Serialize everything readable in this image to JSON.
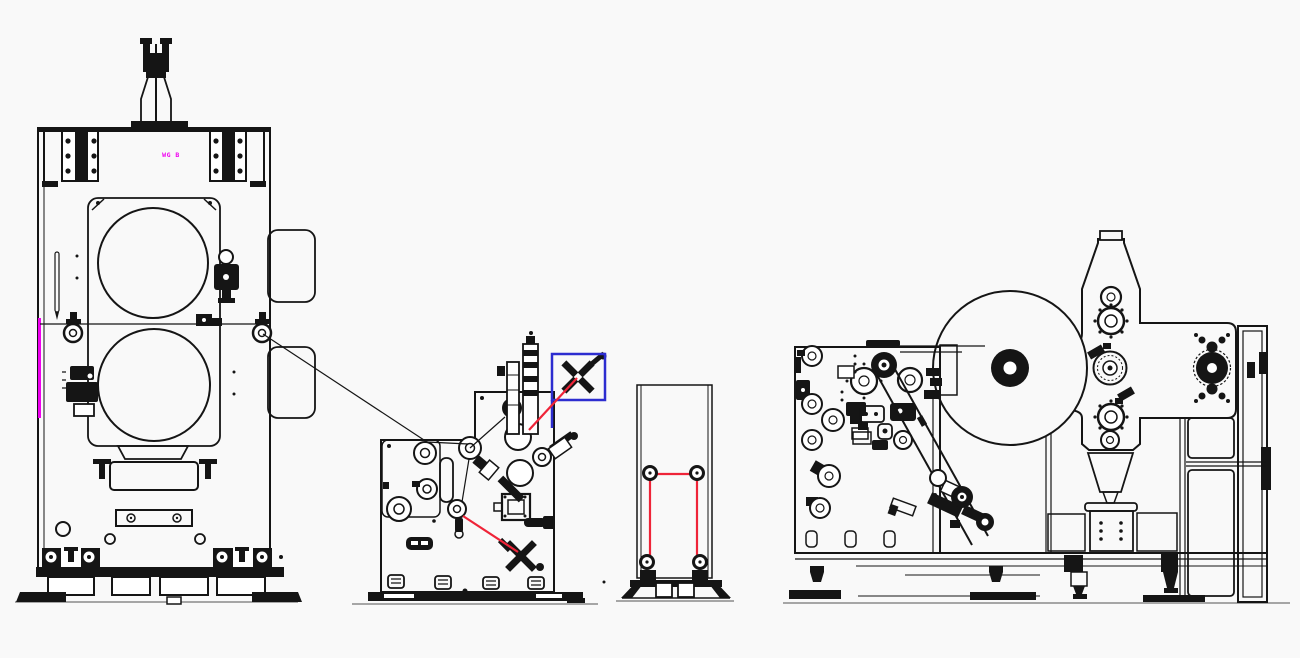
{
  "canvas": {
    "width": 1300,
    "height": 658
  },
  "colors": {
    "background": "#f9f9f9",
    "line": "#151515",
    "ground": "#8a8a8a",
    "web_path_red": "#ef2438",
    "highlight_blue": "#2d2dd0",
    "marker_magenta": "#f000f0"
  },
  "labels": {
    "stamp": "WG B"
  }
}
